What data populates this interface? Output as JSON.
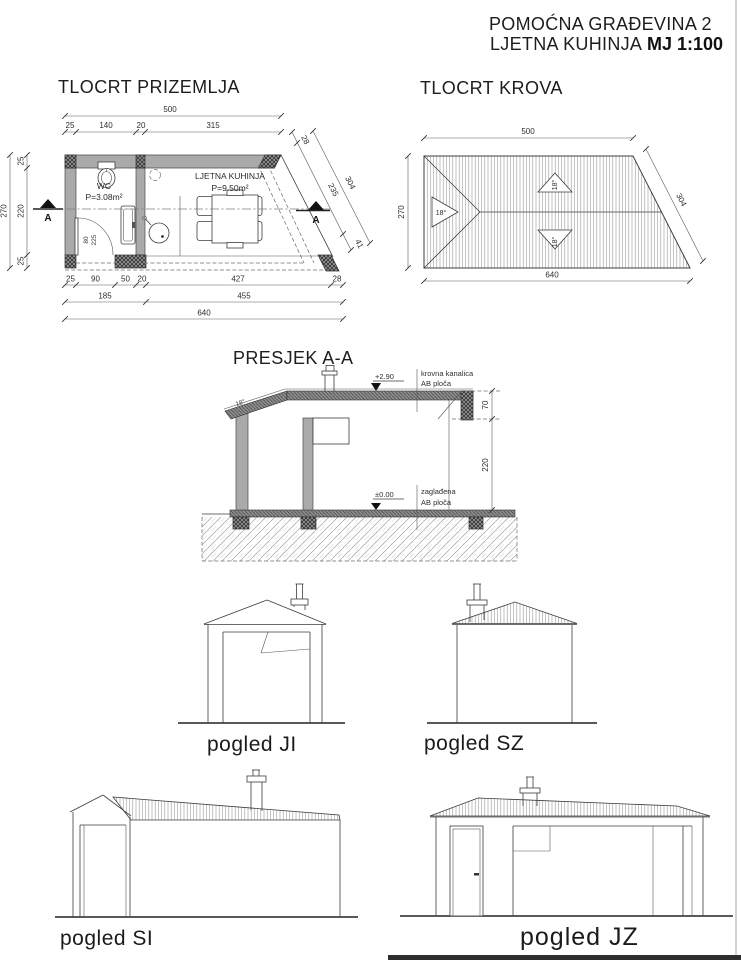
{
  "header": {
    "project": "POMOĆNA GRAĐEVINA 2",
    "subtitle": "LJETNA KUHINJA",
    "scale": "MJ 1:100"
  },
  "floor_plan": {
    "title": "TLOCRT PRIZEMLJA",
    "section_letter": "A",
    "rooms": {
      "wc": {
        "name": "WC",
        "area": "P=3.08m²"
      },
      "kitchen": {
        "name": "LJETNA KUHINJA",
        "area": "P=9.50m²"
      }
    },
    "door": {
      "width": "80",
      "height": "225"
    },
    "dims": {
      "top_total": "500",
      "top": [
        "25",
        "140",
        "20",
        "315"
      ],
      "left_total": "270",
      "left": [
        "25",
        "220",
        "25"
      ],
      "bottom1": [
        "25",
        "90",
        "50",
        "20",
        "427",
        "28"
      ],
      "bottom2": [
        "185",
        "455"
      ],
      "bottom_total": "640",
      "diag": [
        "28",
        "235",
        "41",
        "304"
      ]
    }
  },
  "roof_plan": {
    "title": "TLOCRT KROVA",
    "slope": "18°",
    "dims": {
      "top": "500",
      "left": "270",
      "bottom": "640",
      "diag": "304"
    }
  },
  "section": {
    "title": "PRESJEK A-A",
    "slope": "18°",
    "level_roof": "+2.90",
    "level_floor": "±0.00",
    "roof_label1": "krovna kanalica",
    "roof_label2": "AB ploča",
    "floor_label1": "zaglađena",
    "floor_label2": "AB ploča",
    "dim_roof_edge": "70",
    "dim_wall_height": "220"
  },
  "elevations": {
    "ji": {
      "label": "pogled JI"
    },
    "sz": {
      "label": "pogled SZ"
    },
    "si": {
      "label": "pogled SI"
    },
    "jz": {
      "label": "pogled JZ"
    }
  }
}
